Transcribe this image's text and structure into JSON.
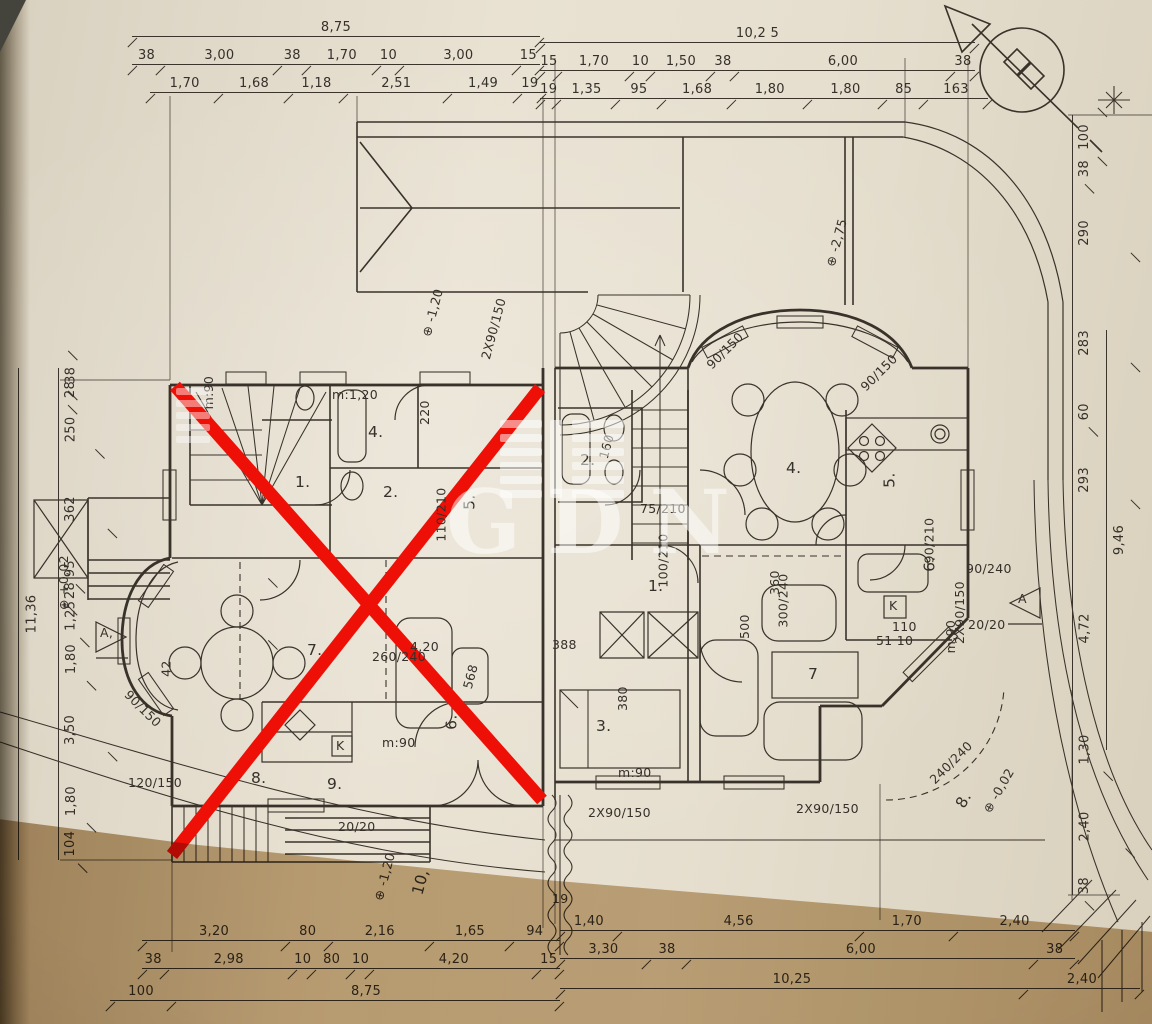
{
  "document": {
    "type": "scanned floor plan",
    "watermark": {
      "text": "GDN"
    },
    "compass": "north-arrow"
  },
  "colors": {
    "ink": "#38322a",
    "red_cross": "#ee1007",
    "paper": "#e7e0d1",
    "paper_shadow": "#c3a87e",
    "watermark": "#ffffff"
  },
  "dims": {
    "top_left": {
      "row1": [
        "8,75"
      ],
      "row2": [
        "38",
        "3,00",
        "38",
        "1,70",
        "10",
        "3,00",
        "15"
      ],
      "row3": [
        "1,70",
        "1,68",
        "1,18",
        "2,51",
        "1,49",
        "19"
      ]
    },
    "top_right": {
      "row1": [
        "10,2 5"
      ],
      "row2": [
        "15",
        "1,70",
        "10",
        "1,50",
        "38",
        "6,00",
        "38"
      ],
      "row3": [
        "19",
        "1,35",
        "95",
        "1,68",
        "1,80",
        "1,80",
        "85",
        "163"
      ]
    },
    "bottom_left": {
      "row1": [
        "3,20",
        "80",
        "2,16",
        "1,65",
        "94"
      ],
      "row2": [
        "38",
        "2,98",
        "10",
        "80",
        "10",
        "4,20",
        "15"
      ],
      "row3": [
        "100",
        "8,75"
      ]
    },
    "bottom_right": {
      "row1": [
        "1,40",
        "4,56",
        "1,70",
        "2,40"
      ],
      "row2": [
        "3,30",
        "38",
        "6,00",
        "38"
      ],
      "row3": [
        "10,25",
        "2,40"
      ]
    },
    "left_col": {
      "total": [
        "11,36"
      ],
      "items": [
        "38",
        "28",
        "250",
        "362",
        "95",
        "28",
        "1,25",
        "1,80",
        "3,50",
        "1,80",
        "104"
      ]
    },
    "right_col": {
      "total": [
        "9,46"
      ],
      "items": [
        "100",
        "38",
        "290",
        "283",
        "60",
        "293",
        "4,72",
        "1,30",
        "2,40",
        "38"
      ]
    }
  },
  "labels": {
    "l1": "1.",
    "l2": "2.",
    "l4": "4.",
    "l5": "5.",
    "l6": "6.",
    "l7": "7.",
    "l8": "8.",
    "l9": "9.",
    "l10": "10,",
    "r1": "1.",
    "r2": "2.",
    "r3": "3.",
    "r4": "4.",
    "r5": "5.",
    "r6": "6.",
    "r7": "7",
    "r8": "8.",
    "tub_left": "m:1,20",
    "sink160": "160",
    "n220": "220",
    "m90_a": "m:90",
    "m90_b": "m:90",
    "m90_c": "m:90",
    "m90_d": "m:90",
    "d75210": "75/210",
    "d100210": "100/210",
    "d110210": "110/210",
    "d90210": "90/210",
    "w90150_a": "90/150",
    "w90150_b": "90/150",
    "w90150_c": "90/150",
    "w120150": "120/150",
    "w2x90_a": "2X90/150",
    "w2x90_b": "2X90/150",
    "w2x90_c": "2X90/150",
    "w2x90_d": "2X90/150",
    "n380": "380",
    "n388": "388",
    "n568": "568",
    "n500": "500",
    "n360": "360",
    "n300240": "300/240",
    "n260240": "260/240",
    "n90240": "90/240",
    "n240240": "240/240",
    "n2020a": "20/20",
    "n2020b": "20/20",
    "n42": "42",
    "n110": "110",
    "n5110": "51 10",
    "n420": "4,20",
    "n19": "19",
    "k1": "K",
    "k2": "K",
    "secA_l": "A,",
    "secA_r": "A"
  },
  "levels": {
    "garage": "⊕ -1,20",
    "court": "⊕ -2,75",
    "front": "⊕ -0,02",
    "left": "⊕ +0,02",
    "gate": "⊕ -1,20"
  }
}
